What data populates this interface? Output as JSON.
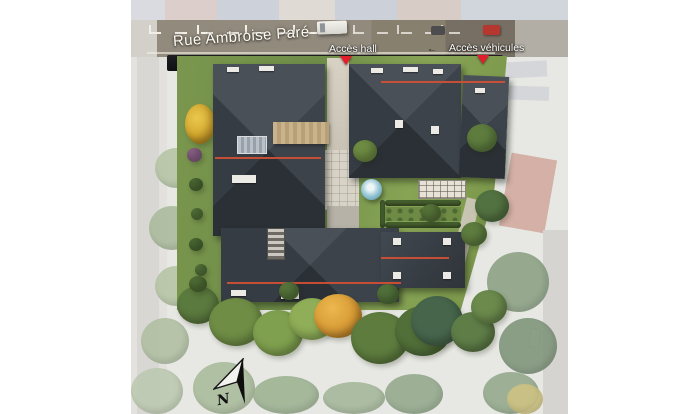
{
  "annotations": {
    "street_name": "Rue Ambroise Paré",
    "access_hall": "Accès hall",
    "access_vehicles": "Accès véhicules",
    "compass_north": "N"
  },
  "icons": {
    "access_hall_marker": "red-triangle-down",
    "access_vehicles_marker": "red-triangle-down",
    "north_arrow": "north-arrow",
    "street_direction_glyph": "←"
  },
  "colors": {
    "page_background": "#ffffff",
    "street": "#8b8377",
    "sidewalk_shadow": "#16171a",
    "roof_dark": "#343a41",
    "roof_ridge_accent": "#cf4f35",
    "lawn_green": "#77924b",
    "tree_autumn_orange": "#d79a35",
    "marker_red": "#e41d2d",
    "road_marking_white": "#f5f2ea",
    "deck_tan": "#c3ab85",
    "parasol_blue": "#9ecbd8",
    "faded_surround": "#e2e3de"
  }
}
